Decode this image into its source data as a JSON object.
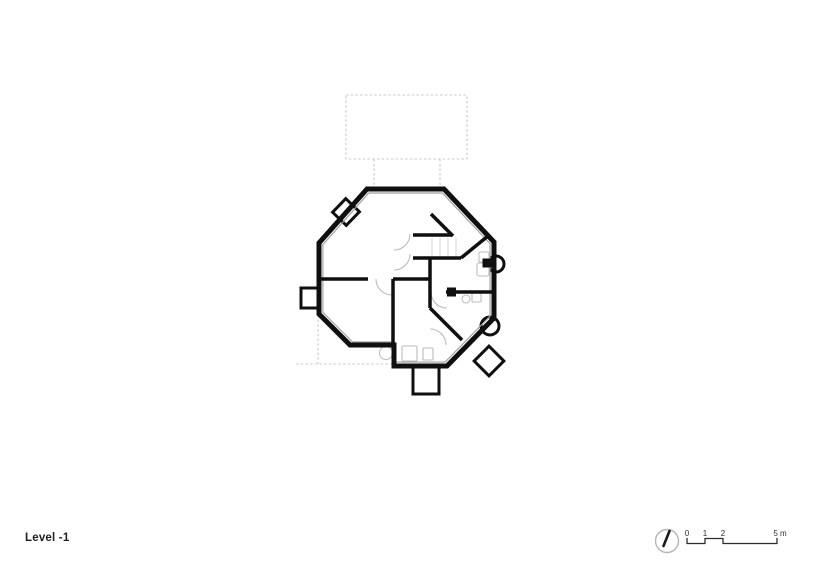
{
  "footer": {
    "level_label": "Level -1"
  },
  "scale_bar": {
    "tick_labels": [
      "0",
      "1",
      "2",
      "5 m"
    ]
  },
  "icons": {
    "north_arrow": "circle-with-needle"
  },
  "colors": {
    "background": "#ffffff",
    "wall": "#0f0f0f",
    "wall_inner_face": "#9f9f9f",
    "plan_details": "#bdbdbd",
    "stair_treads": "#d4d4d4",
    "dashed_outline": "#c9c9c9",
    "annotation": "#2e2e2e",
    "north_arrow_ring": "#b5b5b5"
  }
}
